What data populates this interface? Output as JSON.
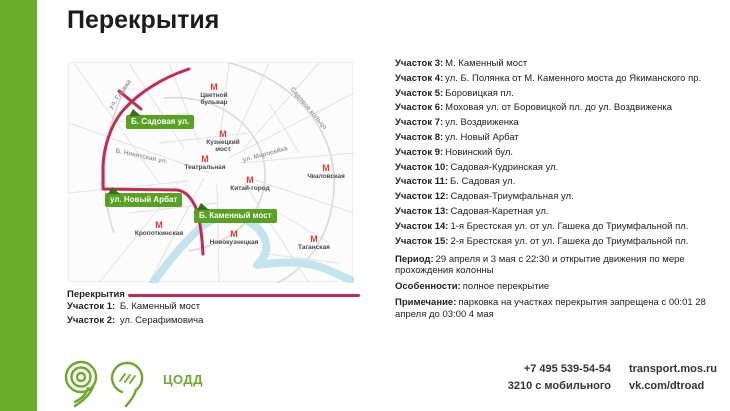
{
  "page": {
    "title": "Перекрытия"
  },
  "colors": {
    "accent_green": "#6aab2b",
    "route_crimson": "#c62a52",
    "metro_red": "#e23b2e",
    "label_green": "#58a222"
  },
  "map": {
    "metro_symbol": "М",
    "metro_stations": [
      {
        "name": "Цветной\nбульвар"
      },
      {
        "name": "Кузнецкий\nмост"
      },
      {
        "name": "Театральная"
      },
      {
        "name": "Китай-город"
      },
      {
        "name": "Чкаловская"
      },
      {
        "name": "Кропоткинская"
      },
      {
        "name": "Новокузнецкая"
      },
      {
        "name": "Таганская"
      }
    ],
    "street_labels": [
      "ул. Гашека",
      "Б. Никитская ул.",
      "ул. Маросейка",
      "Садовое кольцо"
    ],
    "closure_labels": [
      {
        "text": "Б. Садовая ул."
      },
      {
        "text": "ул. Новый Арбат"
      },
      {
        "text": "Б. Каменный мост"
      }
    ]
  },
  "legend": {
    "title": "Перекрытия",
    "items": [
      {
        "label": "Участок 1:",
        "text": "Б. Каменный мост"
      },
      {
        "label": "Участок 2:",
        "text": "ул. Серафимовича"
      }
    ]
  },
  "details": {
    "sections": [
      {
        "label": "Участок 3:",
        "text": "М. Каменный мост"
      },
      {
        "label": "Участок 4:",
        "text": "ул. Б. Полянка от М. Каменного моста до Якиманского пр."
      },
      {
        "label": "Участок 5:",
        "text": "Боровицкая пл."
      },
      {
        "label": "Участок 6:",
        "text": "Моховая ул. от Боровицкой пл. до ул. Воздвиженка"
      },
      {
        "label": "Участок 7:",
        "text": "ул. Воздвиженка"
      },
      {
        "label": "Участок 8:",
        "text": "ул. Новый Арбат"
      },
      {
        "label": "Участок 9:",
        "text": "Новинский бул."
      },
      {
        "label": "Участок 10:",
        "text": "Садовая-Кудринская ул."
      },
      {
        "label": "Участок 11:",
        "text": "Б. Садовая ул."
      },
      {
        "label": "Участок 12:",
        "text": "Садовая-Триумфальная ул."
      },
      {
        "label": "Участок 13:",
        "text": "Садовая-Каретная ул."
      },
      {
        "label": "Участок 14:",
        "text": "1-я Брестская ул. от ул. Гашека до Триумфальной пл."
      },
      {
        "label": "Участок 15:",
        "text": "2-я Брестская ул. от ул. Гашека до Триумфальной пл."
      }
    ],
    "period": {
      "label": "Период:",
      "text": "29 апреля и 3 мая с 22:30 и открытие движения по мере прохождения колонны"
    },
    "features": {
      "label": "Особенности:",
      "text": "полное перекрытие"
    },
    "note": {
      "label": "Примечание:",
      "text": "парковка на участках перекрытия запрещена с 00:01 28 апреля до 03:00 4 мая"
    }
  },
  "footer": {
    "org": "ЦОДД",
    "phone_main": "+7 495 539-54-54",
    "phone_mobile": "3210 с мобильного",
    "site": "transport.mos.ru",
    "social": "vk.com/dtroad"
  }
}
